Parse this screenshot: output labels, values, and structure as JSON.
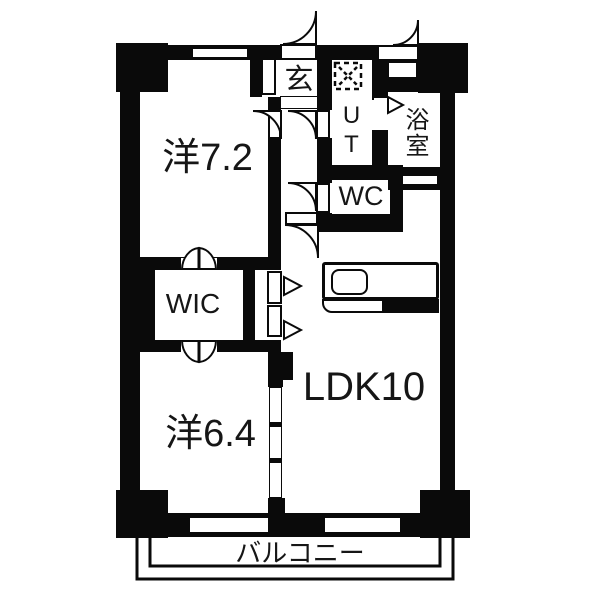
{
  "floorplan": {
    "type": "apartment-floor-plan",
    "background_color": "#ffffff",
    "wall_color": "#0a0a0a",
    "text_color": "#161616",
    "rooms": [
      {
        "key": "western-room-7-2",
        "label": "洋7.2"
      },
      {
        "key": "genkan-entrance",
        "label": "玄"
      },
      {
        "key": "utility",
        "label": "UT"
      },
      {
        "key": "bathroom",
        "label": "浴室"
      },
      {
        "key": "toilet",
        "label": "WC"
      },
      {
        "key": "walk-in-closet",
        "label": "WIC"
      },
      {
        "key": "western-room-6-4",
        "label": "洋6.4"
      },
      {
        "key": "living-dining-kitchen",
        "label": "LDK10"
      },
      {
        "key": "balcony",
        "label": "バルコニー"
      }
    ],
    "icons": {
      "washing_machine": "dashed-square-with-x",
      "door_swing": "quarter-circle-arc",
      "bifold_door": "double-wing",
      "folding_door_arrow": "triangle-right",
      "sliding_door": "segmented-track",
      "kitchen_sink": "rounded-rect"
    }
  }
}
